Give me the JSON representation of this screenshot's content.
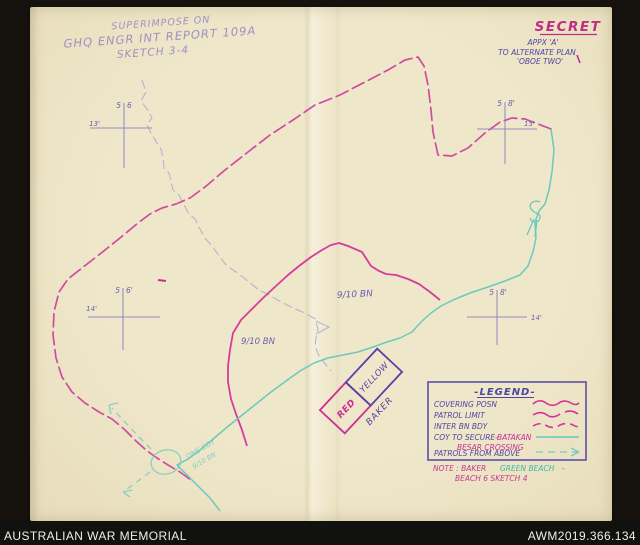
{
  "footer": {
    "institution": "AUSTRALIAN WAR MEMORIAL",
    "accession_number": "AWM2019.366.134"
  },
  "stamp": {
    "line1": "SUPERIMPOSE ON",
    "line2": "GHQ ENGR INT REPORT 109A",
    "line3": "SKETCH 3-4"
  },
  "classification": {
    "label": "SECRET",
    "appendix": "APPX 'A'",
    "plan": "TO ALTERNATE PLAN",
    "codename": "'OBOE TWO'"
  },
  "grid_marks": {
    "nw": {
      "grid_left": "5",
      "grid_right": "6",
      "elev": "13'"
    },
    "ne": {
      "grid_left": "5",
      "grid_right": "8'",
      "elev": "15'"
    },
    "e": {
      "grid_left": "5",
      "grid_right": "8'",
      "elev": "14'"
    },
    "w": {
      "grid_left": "5",
      "grid_right": "6'",
      "elev": "14'"
    }
  },
  "unit_labels": {
    "bn_center": "9/10 BN",
    "bn_west": "9/10 BN",
    "coy_line1": "ONE COY",
    "coy_line2": "9/10 BN"
  },
  "beach_box": {
    "red": "RED",
    "yellow": "YELLOW",
    "baker": "BAKER"
  },
  "legend": {
    "title": "-LEGEND-",
    "rows": [
      {
        "label": "COVERING POSN"
      },
      {
        "label": "PATROL LIMIT"
      },
      {
        "label": "INTER BN BDY"
      },
      {
        "label": "COY TO SECURE-",
        "accent": "BATAKAN",
        "accent2": "BESAR CROSSING"
      },
      {
        "label": "PATROLS FROM ABOVE"
      }
    ]
  },
  "note": {
    "prefix": "NOTE : BAKER",
    "highlight": "GREEN BEACH",
    "dash": "-",
    "line2": "BEACH 6 SKETCH 4"
  },
  "colors": {
    "magenta_line": "#cf42a0",
    "magenta_solid": "#d63199",
    "cyan_line": "#63c8bb",
    "teal_text": "#3db8a2",
    "ink_purple": "#4f46a2",
    "pencil": "#a79fd0",
    "secret": "#bf2d85",
    "paper": "#ece3c4",
    "frame": "#16130f"
  }
}
